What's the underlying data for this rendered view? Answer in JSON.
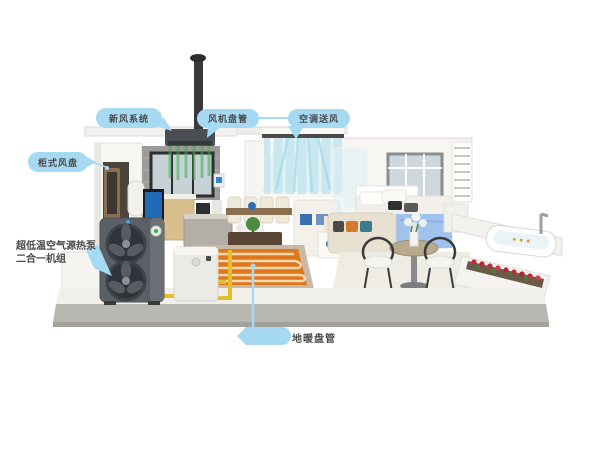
{
  "callouts": {
    "fresh_air": "新风系统",
    "fan_coil": "风机盘管",
    "air_supply": "空调送风",
    "cabinet_fan_coil": "柜式风盘",
    "heat_pump_line1": "超低温空气源热泵",
    "heat_pump_line2": "二合一机组",
    "floor_heating": "地暖盘管"
  },
  "colors": {
    "callout_fill": "#A6D9F2",
    "callout_text": "#4A4A4A",
    "airflow_green": "#3FAE49",
    "airflow_cyan": "#9FDCEA",
    "floor_heating_orange": "#E0761E",
    "pipe_yellow": "#E3BF2A",
    "heat_pump_body": "#596066"
  }
}
